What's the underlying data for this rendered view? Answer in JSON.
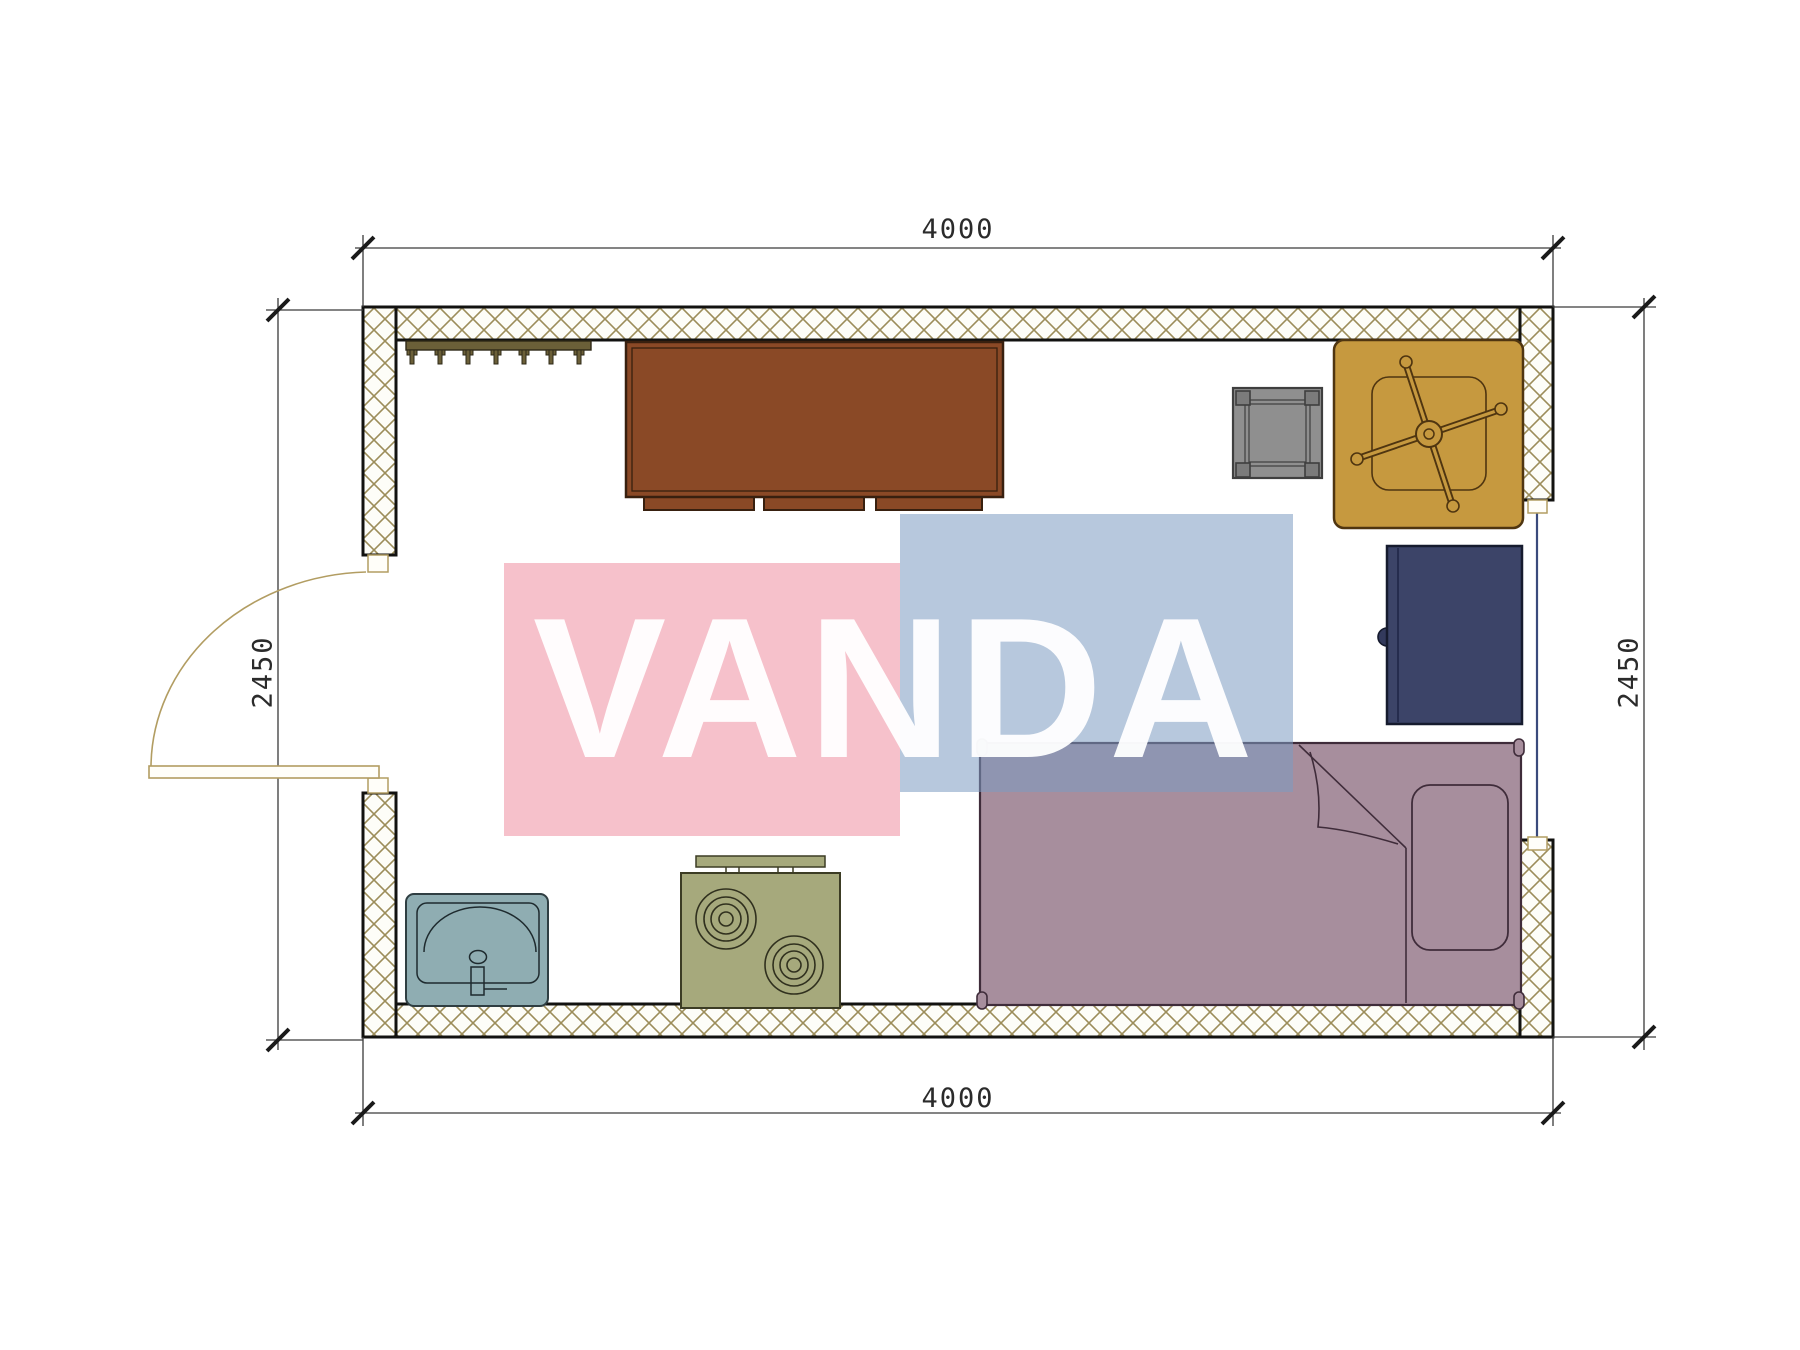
{
  "watermark": {
    "text": "VANDA",
    "pink_rgba": "rgba(238,142,161,0.55)",
    "blue_rgba": "rgba(124,154,193,0.55)",
    "text_rgba": "rgba(255,255,255,0.95)"
  },
  "dimensions": {
    "top": "4000",
    "bottom": "4000",
    "left": "2450",
    "right": "2450"
  },
  "colors": {
    "wall_hatch": "#9C8D5A",
    "wall_outline": "#121210",
    "door": "#B29D62",
    "window_glass": "#3A4A7C",
    "dimension_line": "#3a3a3a"
  },
  "furniture": [
    {
      "name": "coat rack",
      "color": "#6B5F38"
    },
    {
      "name": "desk",
      "color": "#8A4926"
    },
    {
      "name": "stool",
      "color": "#8F8F8F"
    },
    {
      "name": "office chair",
      "color": "#C6993F"
    },
    {
      "name": "cabinet",
      "color": "#3C4468"
    },
    {
      "name": "bed",
      "color": "#A78E9D"
    },
    {
      "name": "sink",
      "color": "#8FADB2"
    },
    {
      "name": "stove",
      "color": "#A6A97C"
    }
  ]
}
